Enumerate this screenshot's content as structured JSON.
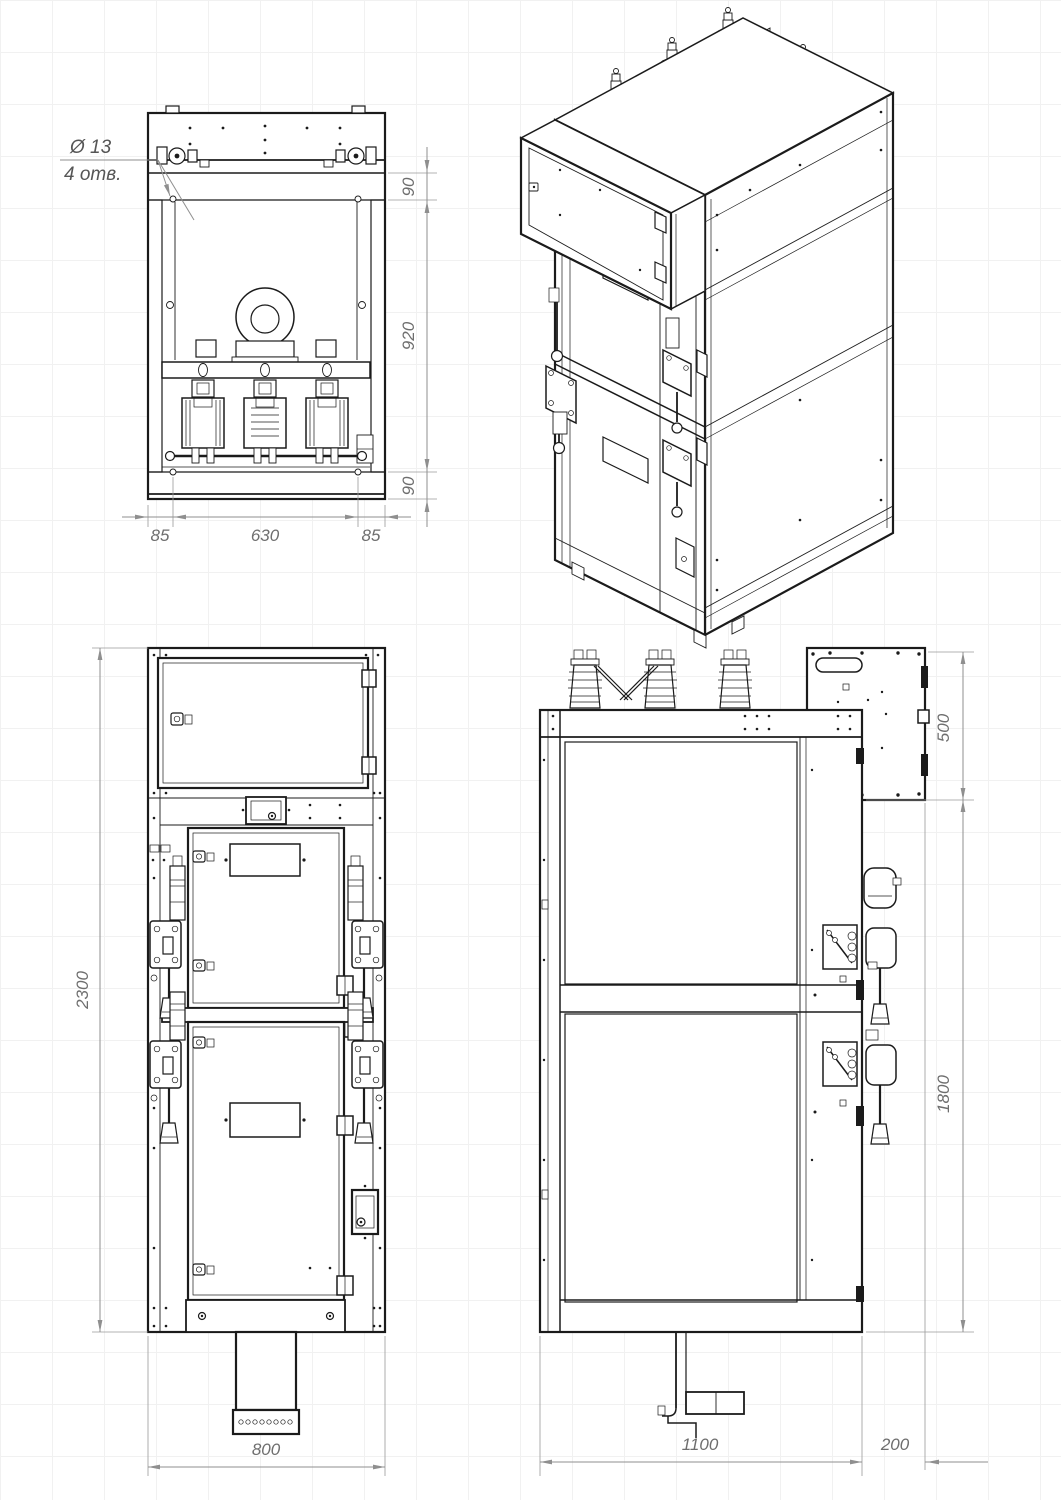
{
  "sheet": {
    "background": "#ffffff",
    "grid_color": "#f1f1f1",
    "line_color": "#1b1b1b",
    "dimension_color": "#8f8f8f",
    "dimension_text_color": "#6e6e6e"
  },
  "annotation": {
    "line1": "Ø 13",
    "line2": "4 отв."
  },
  "views": {
    "top": {
      "dims": {
        "flange_rear": "90",
        "body_depth": "920",
        "flange_front": "90",
        "left_offset": "85",
        "span": "630",
        "right_offset": "85"
      }
    },
    "front": {
      "dims": {
        "height": "2300",
        "width": "800"
      }
    },
    "side": {
      "dims": {
        "relay_box_height": "500",
        "body_height": "1800",
        "depth": "1100",
        "box_projection": "200"
      }
    }
  }
}
